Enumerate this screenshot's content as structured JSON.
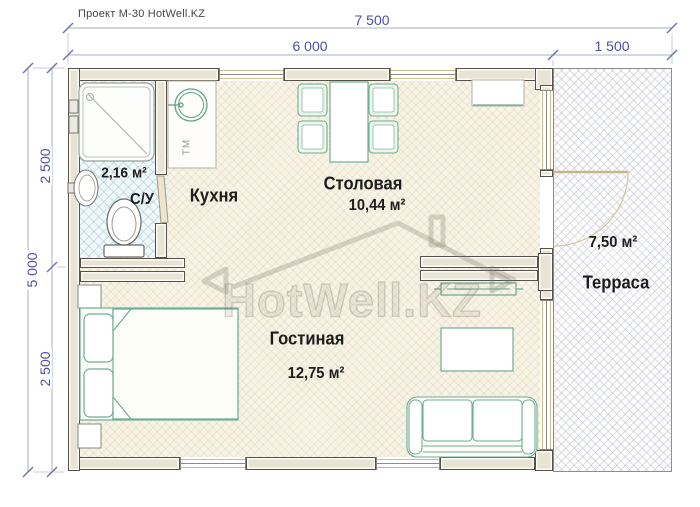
{
  "title": "Проект М-30 HotWell.KZ",
  "watermark": {
    "text": "HotWell.KZ"
  },
  "dims": {
    "total_width": "7 500",
    "inner_width": "6 000",
    "terrace_width": "1 500",
    "total_height": "5 000",
    "upper_height": "2 500",
    "lower_height": "2 500"
  },
  "rooms": {
    "bathroom": {
      "name": "С/У",
      "area": "2,16 м²"
    },
    "kitchen": {
      "name": "Кухня"
    },
    "dining": {
      "name": "Столовая",
      "area": "10,44 м²"
    },
    "living": {
      "name": "Гостиная",
      "area": "12,75 м²"
    },
    "terrace": {
      "name": "Терраса",
      "area": "7,50 м²"
    }
  },
  "fixtures": {
    "kitchen_unit_label": "ТМ"
  },
  "colors": {
    "dimension_text": "#4b4fa6",
    "dimension_line": "#a9b1c9",
    "wall_fill": "#e8e4d4",
    "wall_outline": "#56524a",
    "furniture_outline": "#6fae92",
    "bathroom_tile": "#f1f8fa",
    "terrace_hatch": "#9ba0af"
  }
}
